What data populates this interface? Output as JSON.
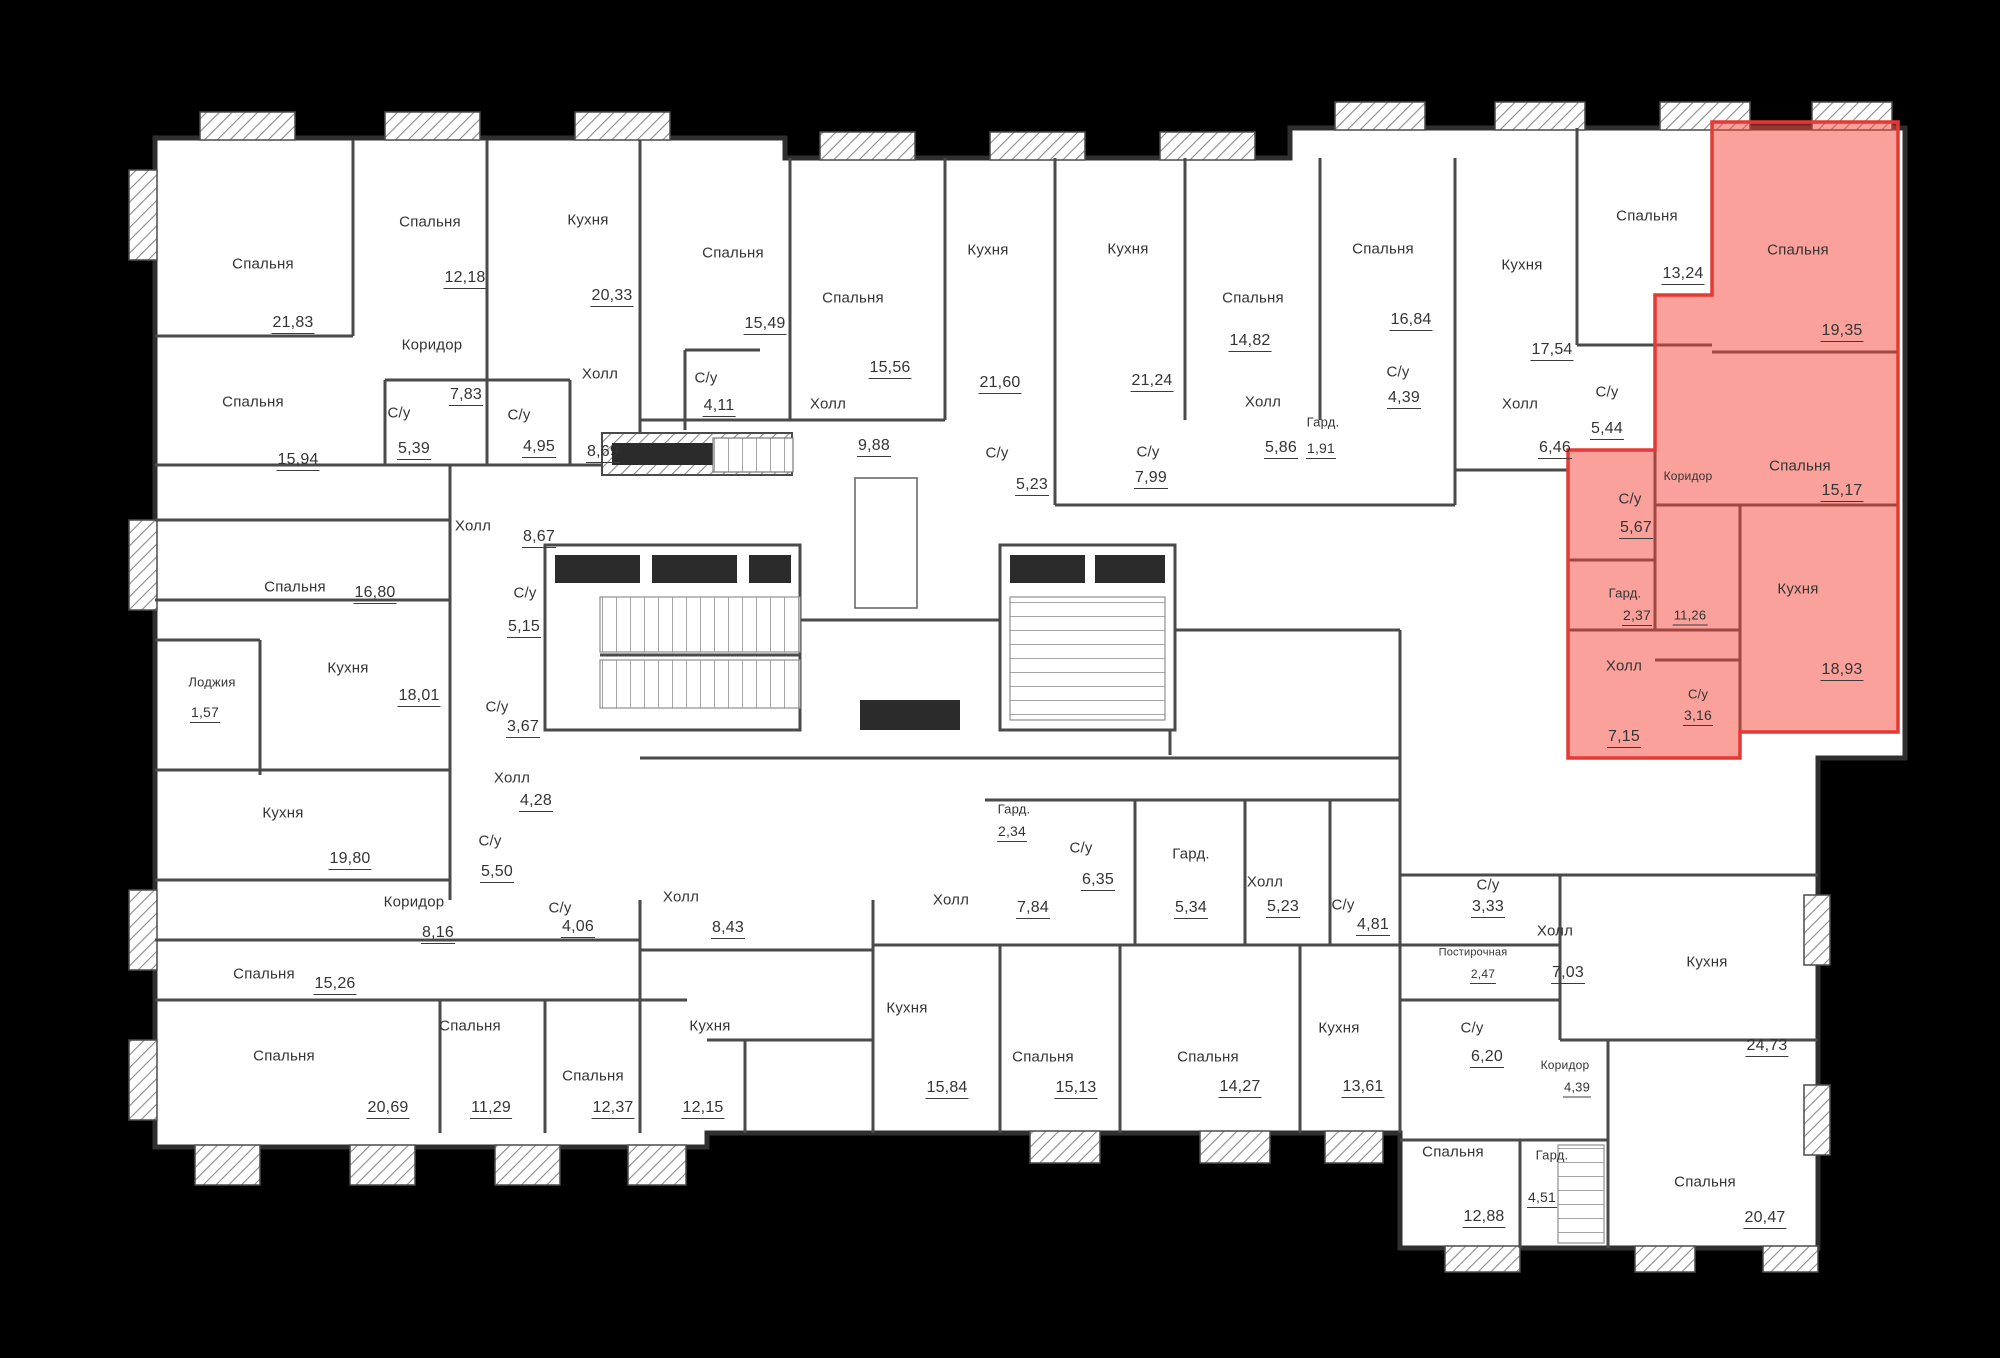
{
  "canvas": {
    "width": 2000,
    "height": 1358,
    "background": "#000000",
    "plan_fill": "#ffffff",
    "wall_color": "#4a4a4a",
    "outline_color": "#2f2f2f",
    "text_color": "#343434",
    "highlight_fill": "#f44336",
    "highlight_stroke": "#e53935"
  },
  "plan_title": "",
  "rooms": [
    {
      "n": "Спальня",
      "a": "21,83",
      "nx": 263,
      "ny": 264,
      "vx": 293,
      "vy": 323
    },
    {
      "n": "Спальня",
      "a": "12,18",
      "nx": 430,
      "ny": 222,
      "vx": 465,
      "vy": 278
    },
    {
      "n": "Кухня",
      "a": "20,33",
      "nx": 588,
      "ny": 220,
      "vx": 612,
      "vy": 296
    },
    {
      "n": "Коридор",
      "a": "7,83",
      "nx": 432,
      "ny": 345,
      "vx": 466,
      "vy": 395
    },
    {
      "n": "Спальня",
      "a": "15,94",
      "nx": 253,
      "ny": 402,
      "vx": 298,
      "vy": 460
    },
    {
      "n": "С/у",
      "a": "5,39",
      "nx": 399,
      "ny": 413,
      "vx": 414,
      "vy": 449
    },
    {
      "n": "С/у",
      "a": "4,95",
      "nx": 519,
      "ny": 415,
      "vx": 539,
      "vy": 447
    },
    {
      "n": "Холл",
      "a": "8,69",
      "nx": 600,
      "ny": 374,
      "vx": 603,
      "vy": 452
    },
    {
      "n": "Спальня",
      "a": "15,49",
      "nx": 733,
      "ny": 253,
      "vx": 765,
      "vy": 324
    },
    {
      "n": "Спальня",
      "a": "15,56",
      "nx": 853,
      "ny": 298,
      "vx": 890,
      "vy": 368
    },
    {
      "n": "Кухня",
      "a": "21,60",
      "nx": 988,
      "ny": 250,
      "vx": 1000,
      "vy": 383
    },
    {
      "n": "С/у",
      "a": "4,11",
      "nx": 706,
      "ny": 378,
      "vx": 719,
      "vy": 406
    },
    {
      "n": "Холл",
      "a": "9,88",
      "nx": 828,
      "ny": 404,
      "vx": 874,
      "vy": 446
    },
    {
      "n": "С/у",
      "a": "5,23",
      "nx": 997,
      "ny": 453,
      "vx": 1032,
      "vy": 485
    },
    {
      "n": "Кухня",
      "a": "21,24",
      "nx": 1128,
      "ny": 249,
      "vx": 1152,
      "vy": 381
    },
    {
      "n": "Спальня",
      "a": "14,82",
      "nx": 1253,
      "ny": 298,
      "vx": 1250,
      "vy": 341
    },
    {
      "n": "Спальня",
      "a": "16,84",
      "nx": 1383,
      "ny": 249,
      "vx": 1411,
      "vy": 320
    },
    {
      "n": "С/у",
      "a": "4,39",
      "nx": 1398,
      "ny": 372,
      "vx": 1404,
      "vy": 398
    },
    {
      "n": "С/у",
      "a": "7,99",
      "nx": 1148,
      "ny": 452,
      "vx": 1151,
      "vy": 478
    },
    {
      "n": "Холл",
      "a": "5,86",
      "nx": 1263,
      "ny": 402,
      "vx": 1281,
      "vy": 448
    },
    {
      "n": "Гард.",
      "a": "1,91",
      "nx": 1323,
      "ny": 422,
      "vx": 1321,
      "vy": 448,
      "s": 13
    },
    {
      "n": "Кухня",
      "a": "17,54",
      "nx": 1522,
      "ny": 265,
      "vx": 1552,
      "vy": 350
    },
    {
      "n": "Спальня",
      "a": "13,24",
      "nx": 1647,
      "ny": 216,
      "vx": 1683,
      "vy": 274
    },
    {
      "n": "Холл",
      "a": "6,46",
      "nx": 1520,
      "ny": 404,
      "vx": 1555,
      "vy": 448
    },
    {
      "n": "С/у",
      "a": "5,44",
      "nx": 1607,
      "ny": 392,
      "vx": 1607,
      "vy": 429
    },
    {
      "n": "Спальня",
      "a": "19,35",
      "nx": 1798,
      "ny": 250,
      "vx": 1842,
      "vy": 331,
      "hl": true
    },
    {
      "n": "Спальня",
      "a": "15,17",
      "nx": 1800,
      "ny": 466,
      "vx": 1842,
      "vy": 491,
      "hl": true
    },
    {
      "n": "Кухня",
      "a": "18,93",
      "nx": 1798,
      "ny": 589,
      "vx": 1842,
      "vy": 670,
      "hl": true
    },
    {
      "n": "Коридор",
      "a": "11,26",
      "nx": 1688,
      "ny": 476,
      "vx": 1690,
      "vy": 615,
      "s": 12,
      "hl": true
    },
    {
      "n": "С/у",
      "a": "5,67",
      "nx": 1630,
      "ny": 499,
      "vx": 1636,
      "vy": 528,
      "hl": true
    },
    {
      "n": "Гард.",
      "a": "2,37",
      "nx": 1625,
      "ny": 593,
      "vx": 1637,
      "vy": 615,
      "s": 13,
      "hl": true
    },
    {
      "n": "Холл",
      "a": "7,15",
      "nx": 1624,
      "ny": 666,
      "vx": 1624,
      "vy": 737,
      "hl": true
    },
    {
      "n": "С/у",
      "a": "3,16",
      "nx": 1698,
      "ny": 694,
      "vx": 1698,
      "vy": 715,
      "s": 13,
      "hl": true
    },
    {
      "n": "Спальня",
      "a": "16,80",
      "nx": 295,
      "ny": 587,
      "vx": 375,
      "vy": 593
    },
    {
      "n": "Кухня",
      "a": "18,01",
      "nx": 348,
      "ny": 668,
      "vx": 419,
      "vy": 696
    },
    {
      "n": "Лоджия",
      "a": "1,57",
      "nx": 212,
      "ny": 682,
      "vx": 205,
      "vy": 712,
      "s": 13
    },
    {
      "n": "Холл",
      "a": "8,67",
      "nx": 473,
      "ny": 526,
      "vx": 539,
      "vy": 537
    },
    {
      "n": "С/у",
      "a": "5,15",
      "nx": 525,
      "ny": 593,
      "vx": 524,
      "vy": 627
    },
    {
      "n": "С/у",
      "a": "3,67",
      "nx": 497,
      "ny": 707,
      "vx": 523,
      "vy": 727
    },
    {
      "n": "Кухня",
      "a": "19,80",
      "nx": 283,
      "ny": 813,
      "vx": 350,
      "vy": 859
    },
    {
      "n": "Коридор",
      "a": "8,16",
      "nx": 414,
      "ny": 902,
      "vx": 438,
      "vy": 933
    },
    {
      "n": "Спальня",
      "a": "15,26",
      "nx": 264,
      "ny": 974,
      "vx": 335,
      "vy": 984
    },
    {
      "n": "Спальня",
      "a": "20,69",
      "nx": 284,
      "ny": 1056,
      "vx": 388,
      "vy": 1108
    },
    {
      "n": "Спальня",
      "a": "11,29",
      "nx": 470,
      "ny": 1026,
      "vx": 491,
      "vy": 1108
    },
    {
      "n": "Спальня",
      "a": "12,37",
      "nx": 593,
      "ny": 1076,
      "vx": 613,
      "vy": 1108
    },
    {
      "n": "Холл",
      "a": "4,28",
      "nx": 512,
      "ny": 778,
      "vx": 536,
      "vy": 801
    },
    {
      "n": "С/у",
      "a": "5,50",
      "nx": 490,
      "ny": 841,
      "vx": 497,
      "vy": 872
    },
    {
      "n": "С/у",
      "a": "4,06",
      "nx": 560,
      "ny": 908,
      "vx": 578,
      "vy": 927
    },
    {
      "n": "Холл",
      "a": "8,43",
      "nx": 681,
      "ny": 897,
      "vx": 728,
      "vy": 928
    },
    {
      "n": "Кухня",
      "a": "12,15",
      "nx": 710,
      "ny": 1026,
      "vx": 703,
      "vy": 1108
    },
    {
      "n": "Холл",
      "a": "7,84",
      "nx": 951,
      "ny": 900,
      "vx": 1033,
      "vy": 908
    },
    {
      "n": "Гард.",
      "a": "2,34",
      "nx": 1014,
      "ny": 809,
      "vx": 1012,
      "vy": 831,
      "s": 13
    },
    {
      "n": "С/у",
      "a": "6,35",
      "nx": 1081,
      "ny": 848,
      "vx": 1098,
      "vy": 880
    },
    {
      "n": "Гард.",
      "a": "5,34",
      "nx": 1191,
      "ny": 854,
      "vx": 1191,
      "vy": 908
    },
    {
      "n": "Кухня",
      "a": "15,84",
      "nx": 907,
      "ny": 1008,
      "vx": 947,
      "vy": 1088
    },
    {
      "n": "Спальня",
      "a": "15,13",
      "nx": 1043,
      "ny": 1057,
      "vx": 1076,
      "vy": 1088
    },
    {
      "n": "Спальня",
      "a": "14,27",
      "nx": 1208,
      "ny": 1057,
      "vx": 1240,
      "vy": 1087
    },
    {
      "n": "Кухня",
      "a": "13,61",
      "nx": 1339,
      "ny": 1028,
      "vx": 1363,
      "vy": 1087
    },
    {
      "n": "Холл",
      "a": "5,23",
      "nx": 1265,
      "ny": 882,
      "vx": 1283,
      "vy": 907
    },
    {
      "n": "С/у",
      "a": "4,81",
      "nx": 1343,
      "ny": 905,
      "vx": 1373,
      "vy": 925
    },
    {
      "n": "С/у",
      "a": "3,33",
      "nx": 1488,
      "ny": 885,
      "vx": 1488,
      "vy": 907
    },
    {
      "n": "Постирочная",
      "a": "2,47",
      "nx": 1473,
      "ny": 953,
      "vx": 1483,
      "vy": 974,
      "s": 11
    },
    {
      "n": "Холл",
      "a": "7,03",
      "nx": 1555,
      "ny": 931,
      "vx": 1568,
      "vy": 973
    },
    {
      "n": "С/у",
      "a": "6,20",
      "nx": 1472,
      "ny": 1028,
      "vx": 1487,
      "vy": 1057
    },
    {
      "n": "Коридор",
      "a": "4,39",
      "nx": 1565,
      "ny": 1065,
      "vx": 1577,
      "vy": 1087,
      "s": 12
    },
    {
      "n": "Кухня",
      "a": "24,73",
      "nx": 1707,
      "ny": 962,
      "vx": 1767,
      "vy": 1046
    },
    {
      "n": "Спальня",
      "a": "20,47",
      "nx": 1705,
      "ny": 1182,
      "vx": 1765,
      "vy": 1218
    },
    {
      "n": "Спальня",
      "a": "12,88",
      "nx": 1453,
      "ny": 1152,
      "vx": 1484,
      "vy": 1217
    },
    {
      "n": "Гард.",
      "a": "4,51",
      "nx": 1552,
      "ny": 1155,
      "vx": 1542,
      "vy": 1197,
      "s": 13
    }
  ]
}
